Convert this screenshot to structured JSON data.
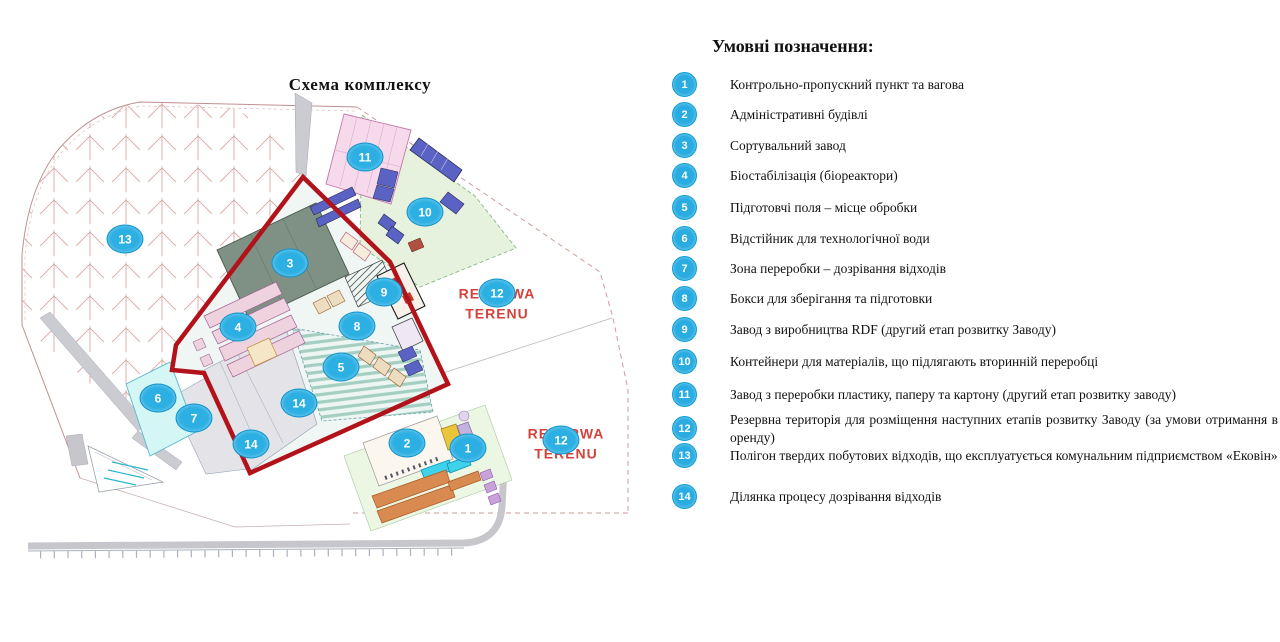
{
  "map": {
    "title": "Схема комплексу",
    "reserve": {
      "line1": "REZERWA",
      "line2": "TERENU"
    },
    "markers": [
      {
        "number": "13"
      },
      {
        "number": "11"
      },
      {
        "number": "10"
      },
      {
        "number": "3"
      },
      {
        "number": "9"
      },
      {
        "number": "12"
      },
      {
        "number": "4"
      },
      {
        "number": "8"
      },
      {
        "number": "5"
      },
      {
        "number": "6"
      },
      {
        "number": "7"
      },
      {
        "number": "14"
      },
      {
        "number": "14"
      },
      {
        "number": "2"
      },
      {
        "number": "1"
      },
      {
        "number": "12"
      }
    ]
  },
  "legend": {
    "title": "Умовні позначення:",
    "items": [
      {
        "number": "1",
        "label": "Контрольно-пропускний пункт та вагова"
      },
      {
        "number": "2",
        "label": "Адміністративні будівлі"
      },
      {
        "number": "3",
        "label": "Сортувальний завод"
      },
      {
        "number": "4",
        "label": "Біостабілізація (біореактори)"
      },
      {
        "number": "5",
        "label": "Підготовчі поля – місце обробки"
      },
      {
        "number": "6",
        "label": "Відстійник для технологічної води"
      },
      {
        "number": "7",
        "label": "Зона переробки – дозрівання відходів"
      },
      {
        "number": "8",
        "label": "Бокси для зберігання та підготовки"
      },
      {
        "number": "9",
        "label": "Завод з виробництва RDF (другий етап розвитку Заводу)"
      },
      {
        "number": "10",
        "label": "Контейнери для матеріалів, що підлягають вторинній переробці"
      },
      {
        "number": "11",
        "label": "Завод з переробки пластику, паперу та картону (другий етап розвитку заводу)"
      },
      {
        "number": "12",
        "label": "Резервна територія для розміщення наступних етапів розвитку Заводу (за умови отримання в оренду)"
      },
      {
        "number": "13",
        "label": "Полігон твердих побутових відходів, що експлуатується комунальним підприємством «Ековін»"
      },
      {
        "number": "14",
        "label": "Ділянка процесу дозрівання відходів"
      }
    ]
  },
  "colors": {
    "marker_blue": "#2cafe3",
    "boundary_red": "#b2121a",
    "reserve_text_red": "#d5423c"
  }
}
